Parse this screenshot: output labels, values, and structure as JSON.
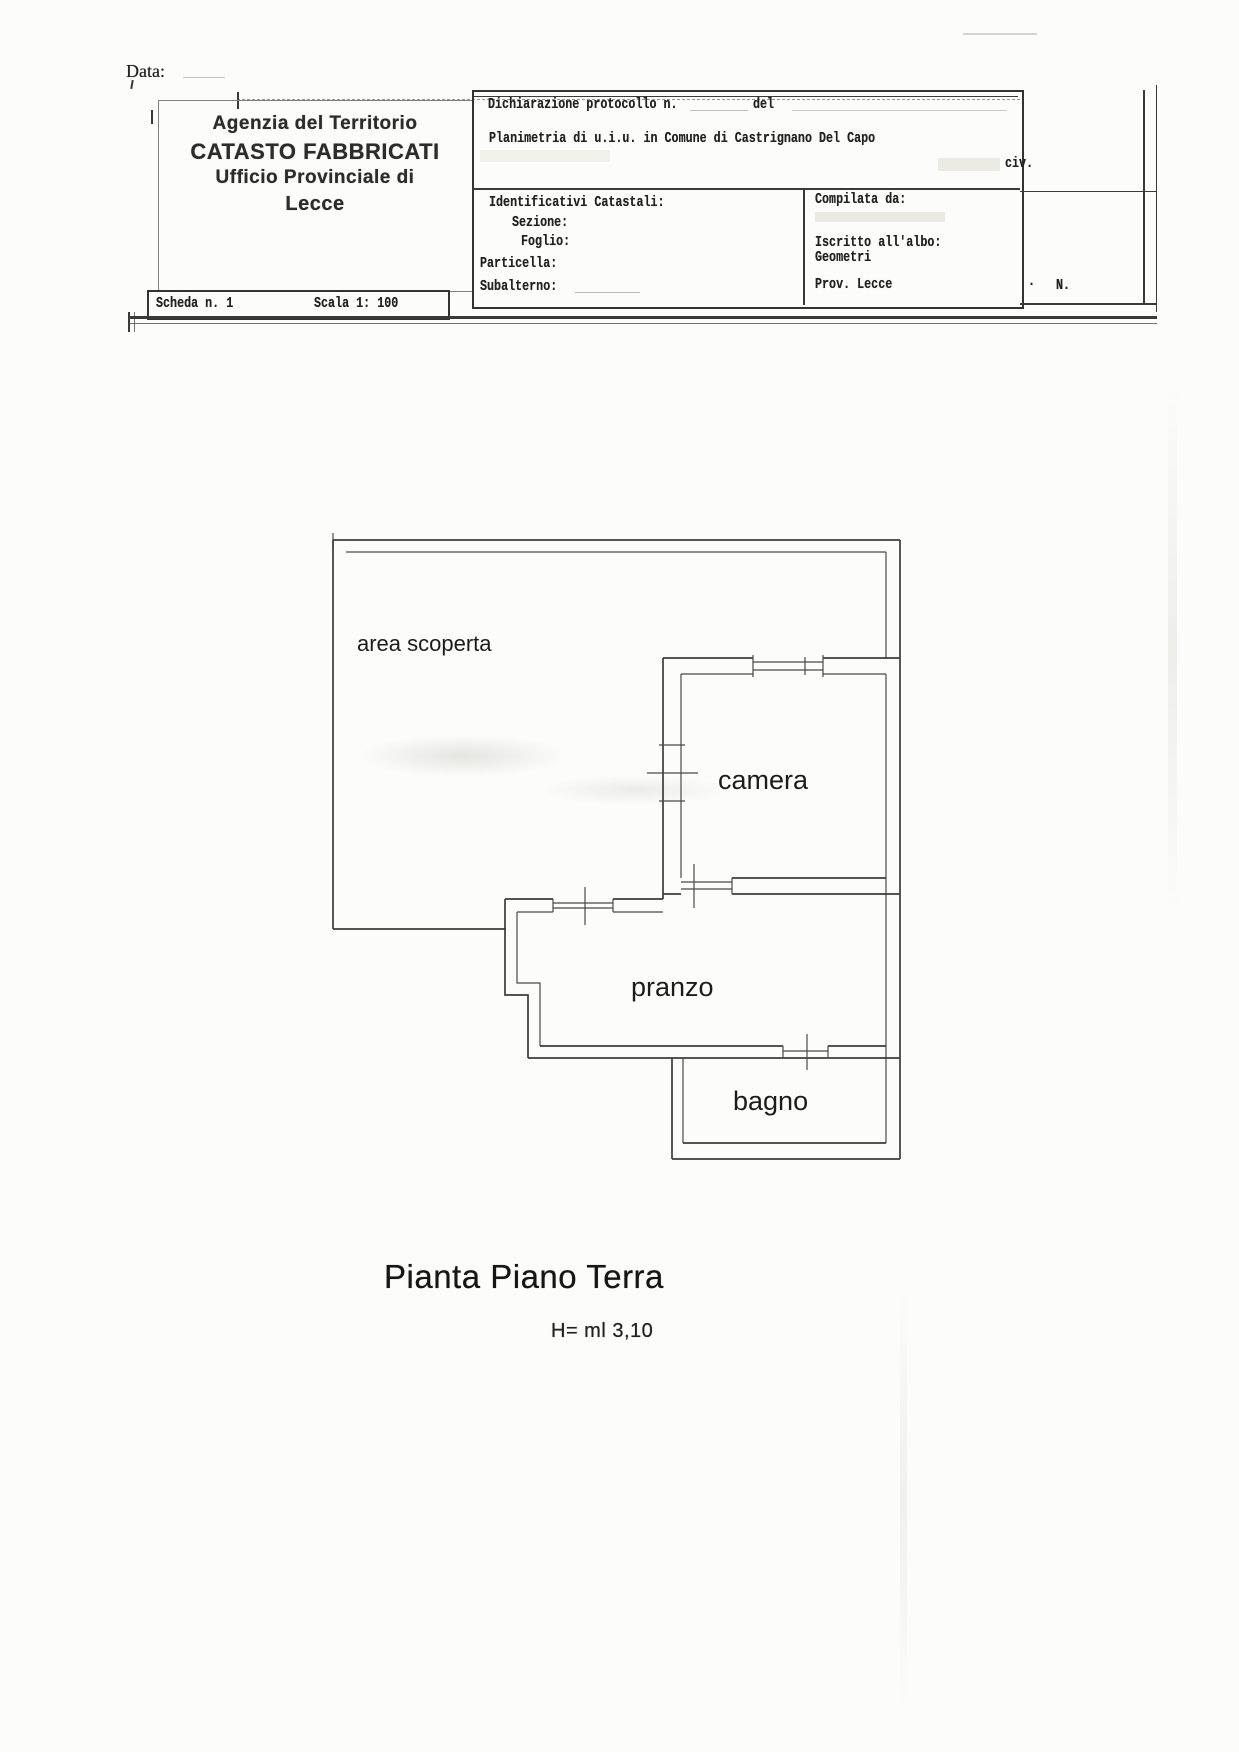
{
  "document": {
    "date_label": "Data:",
    "office": {
      "line1": "Agenzia del Territorio",
      "line2": "CATASTO FABBRICATI",
      "line3": "Ufficio Provinciale di",
      "line4": "Lecce"
    },
    "form": {
      "declaration_label": "Dichiarazione protocollo n.",
      "del_label": "del",
      "planimetria_line": "Planimetria di u.i.u. in Comune di Castrignano Del Capo",
      "civ_label": "civ.",
      "identificativi_title": "Identificativi Catastali:",
      "sezione_label": "Sezione:",
      "foglio_label": "Foglio:",
      "particella_label": "Particella:",
      "subalterno_label": "Subalterno:",
      "compilata_label": "Compilata da:",
      "iscritto_label": "Iscritto all'albo:",
      "iscritto_value": "Geometri",
      "prov_label": "Prov. Lecce",
      "dot": "·",
      "n_label": "N."
    },
    "scheda": {
      "scheda_label": "Scheda n. 1",
      "scala_label": "Scala 1: 100"
    }
  },
  "plan": {
    "rooms": [
      {
        "label": "area scoperta"
      },
      {
        "label": "camera"
      },
      {
        "label": "pranzo"
      },
      {
        "label": "bagno"
      }
    ],
    "title": "Pianta Piano Terra",
    "height_label": "H= ml 3,10"
  }
}
